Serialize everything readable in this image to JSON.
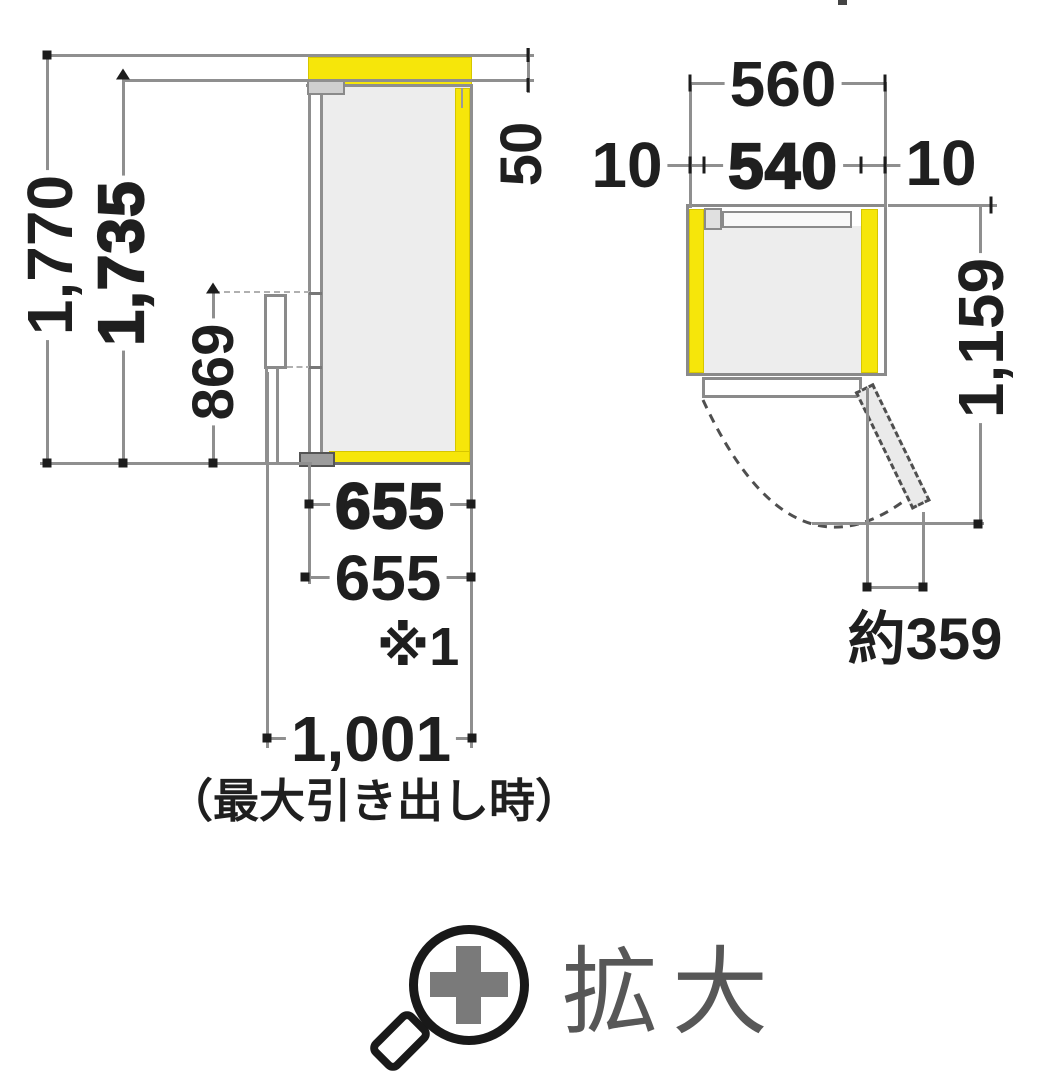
{
  "side_view": {
    "height_total": "1,770",
    "height_body": "1,735",
    "height_handle": "869",
    "clearance_top": "50",
    "depth_body_bold": "655",
    "depth_body": "655",
    "footnote_ref": "※1",
    "depth_drawer_open": "1,001",
    "depth_drawer_open_caption": "（最大引き出し時）"
  },
  "top_view": {
    "width_total": "560",
    "clearance_left": "10",
    "width_body": "540",
    "clearance_right": "10",
    "depth_door_open": "1,159",
    "door_swing_protrusion": "約359"
  },
  "zoom_control": {
    "label": "拡大"
  },
  "colors": {
    "clearance_highlight": "#f6e60a",
    "line_gray": "#8f8f8f",
    "text_dark": "#1f1f1f",
    "icon_gray": "#7a7a7a"
  }
}
